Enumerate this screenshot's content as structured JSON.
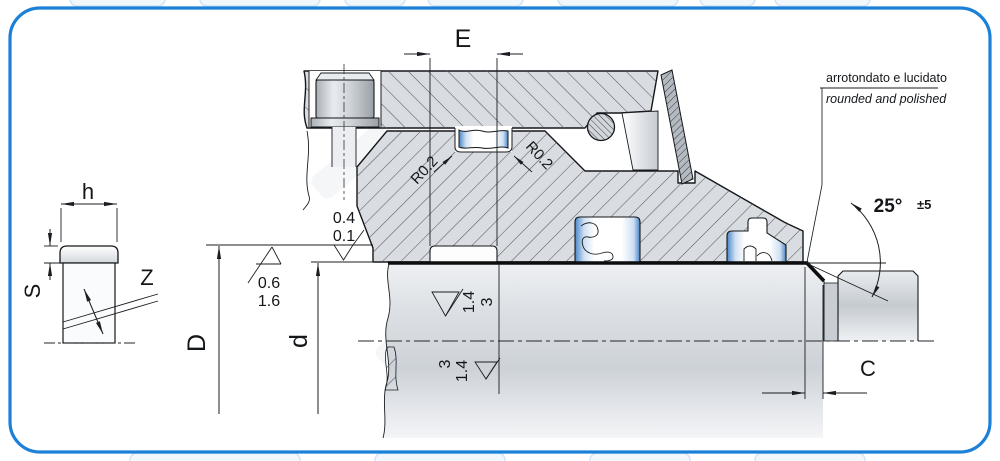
{
  "drawing": {
    "dimension_labels": {
      "groove_width": "E",
      "ring_width": "h",
      "ring_thickness": "S",
      "ring_cut": "Z",
      "groove_diameter": "D",
      "rod_diameter": "d",
      "chamfer_length": "C"
    },
    "radius_labels": {
      "left": "R0.2",
      "right": "R0.2"
    },
    "angle": {
      "value": "25°",
      "tolerance": "±5"
    },
    "surface_finish": {
      "groove_flank": {
        "top": "0.4",
        "bottom": "0.1"
      },
      "groove_root": {
        "top": "0.6",
        "bottom": "1.6"
      },
      "rod_above_axis": {
        "first": "1.4",
        "second": "3"
      },
      "rod_below_axis": {
        "first": "3",
        "second": "1.4"
      }
    },
    "chamfer_note": {
      "italian": "arrotondato e lucidato",
      "english": "rounded and polished"
    },
    "colors": {
      "border": "#1b80d7",
      "hatch_fill": "#d9dce0",
      "seal_accent": "#4a86c8",
      "line": "#1a1d21"
    }
  }
}
